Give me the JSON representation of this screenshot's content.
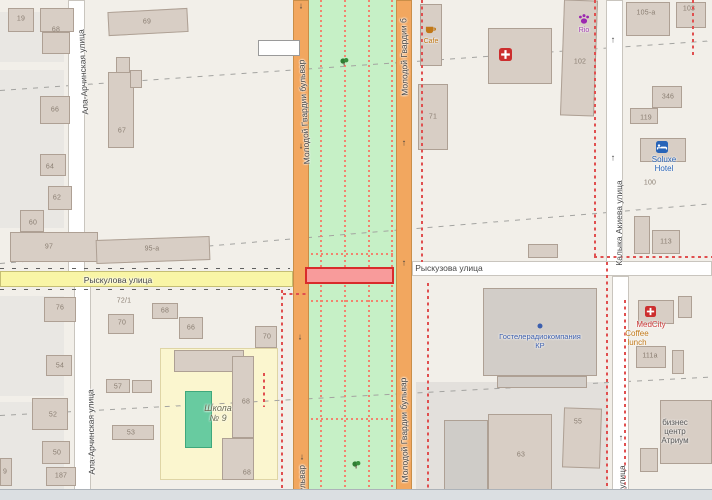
{
  "map": {
    "canvas": {
      "width": 712,
      "height": 500,
      "land_color": "#F2EFE9"
    },
    "landuse": [
      {
        "name": "landuse-residential",
        "x": 0,
        "y": 12,
        "w": 64,
        "h": 50,
        "color": "#E9E7E3"
      },
      {
        "name": "landuse-residential",
        "x": 0,
        "y": 70,
        "w": 64,
        "h": 158,
        "color": "#E9E7E3"
      },
      {
        "name": "landuse-residential",
        "x": 0,
        "y": 296,
        "w": 64,
        "h": 100,
        "color": "#E9E7E3"
      },
      {
        "name": "landuse-residential",
        "x": 0,
        "y": 402,
        "w": 64,
        "h": 98,
        "color": "#E9E7E3"
      },
      {
        "name": "landuse-grass-median",
        "x": 309,
        "y": 0,
        "w": 87,
        "h": 500,
        "color": "#C6F0C6"
      },
      {
        "name": "landuse-school",
        "x": 160,
        "y": 348,
        "w": 118,
        "h": 132,
        "color": "#FBF6CF",
        "border": "#DFD5A5"
      },
      {
        "name": "landuse-retail-gray",
        "x": 416,
        "y": 382,
        "w": 192,
        "h": 118,
        "color": "#E3E0DC"
      }
    ],
    "roads": [
      {
        "name": "road-ala-archinskaya-north",
        "x": 68,
        "y": 0,
        "w": 17,
        "h": 272,
        "fill": "#FFFFFF",
        "casing": "#C9C5BE"
      },
      {
        "name": "road-ala-archinskaya-south",
        "x": 74,
        "y": 286,
        "w": 17,
        "h": 214,
        "fill": "#FFFFFF",
        "casing": "#C9C5BE"
      },
      {
        "name": "road-kalyka-akieva-north",
        "x": 606,
        "y": 0,
        "w": 17,
        "h": 262,
        "fill": "#FFFFFF",
        "casing": "#C9C5BE"
      },
      {
        "name": "road-kalyka-akieva-south",
        "x": 612,
        "y": 276,
        "w": 17,
        "h": 224,
        "fill": "#FFFFFF",
        "casing": "#C9C5BE"
      },
      {
        "name": "road-ryskulova-west",
        "x": 0,
        "y": 271,
        "w": 293,
        "h": 16,
        "fill": "#F9F5A6",
        "casing": "#C5BE74"
      },
      {
        "name": "road-ryskulova-east",
        "x": 412,
        "y": 261,
        "w": 300,
        "h": 15,
        "fill": "#FFFFFF",
        "casing": "#C9C5BE"
      },
      {
        "name": "road-blvd-west-carriageway",
        "x": 293,
        "y": 0,
        "w": 16,
        "h": 500,
        "fill": "#F2A75F",
        "casing": "#C98E48"
      },
      {
        "name": "road-blvd-east-carriageway",
        "x": 396,
        "y": 0,
        "w": 16,
        "h": 500,
        "fill": "#F2A75F",
        "casing": "#C98E48"
      }
    ],
    "road_ticks": [
      {
        "x": 0,
        "y": 267.5,
        "w": 290
      },
      {
        "x": 0,
        "y": 288.5,
        "w": 290
      }
    ],
    "boundaries_gray": [
      {
        "x": 0,
        "y": 90,
        "len": 716,
        "angle": -4.0
      },
      {
        "x": 0,
        "y": 263,
        "len": 716,
        "angle": -4.8
      },
      {
        "x": 0,
        "y": 415,
        "len": 716,
        "angle": -3.1
      }
    ],
    "boundaries_red": [
      {
        "orient": "v",
        "x": 421,
        "y": 0,
        "len": 262
      },
      {
        "orient": "v",
        "x": 427,
        "y": 283,
        "len": 217
      },
      {
        "orient": "v",
        "x": 281,
        "y": 290,
        "len": 210
      },
      {
        "orient": "v",
        "x": 263,
        "y": 373,
        "len": 34
      },
      {
        "orient": "h",
        "x": 283,
        "y": 293,
        "len": 26
      },
      {
        "orient": "v",
        "x": 594,
        "y": 0,
        "len": 256
      },
      {
        "orient": "h",
        "x": 594,
        "y": 256,
        "len": 118
      },
      {
        "orient": "v",
        "x": 606,
        "y": 262,
        "len": 238
      },
      {
        "orient": "v",
        "x": 624,
        "y": 300,
        "len": 200
      },
      {
        "orient": "v",
        "x": 692,
        "y": 0,
        "len": 55
      }
    ],
    "footpaths_dotted": [
      {
        "orient": "v",
        "x": 320,
        "y": 0,
        "len": 500
      },
      {
        "orient": "v",
        "x": 344,
        "y": 0,
        "len": 500
      },
      {
        "orient": "v",
        "x": 368,
        "y": 0,
        "len": 500
      },
      {
        "orient": "v",
        "x": 391,
        "y": 0,
        "len": 500
      },
      {
        "orient": "h",
        "x": 311,
        "y": 253,
        "len": 85
      },
      {
        "orient": "h",
        "x": 311,
        "y": 300,
        "len": 85
      },
      {
        "orient": "h",
        "x": 311,
        "y": 418,
        "len": 85
      }
    ],
    "highlight": {
      "name": "selection-highlight",
      "x": 305,
      "y": 267,
      "w": 89,
      "h": 17,
      "fill": "#F89B9B",
      "border": "#D92B2B"
    },
    "buildings": [
      {
        "x": 8,
        "y": 8,
        "w": 26,
        "h": 24
      },
      {
        "x": 40,
        "y": 8,
        "w": 34,
        "h": 24
      },
      {
        "x": 42,
        "y": 32,
        "w": 28,
        "h": 22
      },
      {
        "x": 108,
        "y": 10,
        "w": 80,
        "h": 24,
        "rot": -3
      },
      {
        "x": 116,
        "y": 57,
        "w": 14,
        "h": 30
      },
      {
        "x": 40,
        "y": 96,
        "w": 30,
        "h": 28
      },
      {
        "x": 108,
        "y": 72,
        "w": 26,
        "h": 76
      },
      {
        "x": 130,
        "y": 70,
        "w": 12,
        "h": 18
      },
      {
        "x": 40,
        "y": 154,
        "w": 26,
        "h": 22
      },
      {
        "x": 48,
        "y": 186,
        "w": 24,
        "h": 24
      },
      {
        "x": 20,
        "y": 210,
        "w": 24,
        "h": 22
      },
      {
        "x": 10,
        "y": 232,
        "w": 88,
        "h": 30
      },
      {
        "x": 96,
        "y": 238,
        "w": 114,
        "h": 24,
        "rot": -2
      },
      {
        "x": 258,
        "y": 40,
        "w": 42,
        "h": 16,
        "fill": "#FFFFFF",
        "border": "#9A9A9A"
      },
      {
        "x": 420,
        "y": 4,
        "w": 22,
        "h": 62
      },
      {
        "x": 488,
        "y": 28,
        "w": 64,
        "h": 56
      },
      {
        "x": 418,
        "y": 84,
        "w": 30,
        "h": 66
      },
      {
        "x": 562,
        "y": 0,
        "w": 34,
        "h": 116,
        "rot": 2
      },
      {
        "x": 626,
        "y": 2,
        "w": 44,
        "h": 34
      },
      {
        "x": 676,
        "y": 2,
        "w": 30,
        "h": 26
      },
      {
        "x": 652,
        "y": 86,
        "w": 30,
        "h": 22
      },
      {
        "x": 630,
        "y": 108,
        "w": 28,
        "h": 16
      },
      {
        "x": 640,
        "y": 138,
        "w": 46,
        "h": 24
      },
      {
        "x": 634,
        "y": 216,
        "w": 16,
        "h": 38
      },
      {
        "x": 652,
        "y": 230,
        "w": 28,
        "h": 24
      },
      {
        "x": 528,
        "y": 244,
        "w": 30,
        "h": 14
      },
      {
        "x": 483,
        "y": 288,
        "w": 114,
        "h": 88,
        "fill": "#D2CDC8"
      },
      {
        "x": 497,
        "y": 376,
        "w": 90,
        "h": 12,
        "fill": "#D2CDC8"
      },
      {
        "x": 638,
        "y": 300,
        "w": 36,
        "h": 24
      },
      {
        "x": 678,
        "y": 296,
        "w": 14,
        "h": 22
      },
      {
        "x": 636,
        "y": 346,
        "w": 30,
        "h": 22
      },
      {
        "x": 672,
        "y": 350,
        "w": 12,
        "h": 24
      },
      {
        "x": 660,
        "y": 400,
        "w": 52,
        "h": 64
      },
      {
        "x": 640,
        "y": 448,
        "w": 18,
        "h": 24
      },
      {
        "x": 563,
        "y": 408,
        "w": 38,
        "h": 60,
        "rot": 2
      },
      {
        "x": 488,
        "y": 414,
        "w": 64,
        "h": 84
      },
      {
        "x": 444,
        "y": 420,
        "w": 44,
        "h": 74,
        "fill": "#CFCCC8"
      },
      {
        "x": 174,
        "y": 350,
        "w": 70,
        "h": 22
      },
      {
        "x": 232,
        "y": 356,
        "w": 22,
        "h": 82
      },
      {
        "x": 222,
        "y": 438,
        "w": 32,
        "h": 42
      },
      {
        "x": 185,
        "y": 391,
        "w": 27,
        "h": 57,
        "fill": "#68CBA0",
        "border": "#3FA87C"
      },
      {
        "x": 108,
        "y": 314,
        "w": 26,
        "h": 20
      },
      {
        "x": 152,
        "y": 303,
        "w": 26,
        "h": 16
      },
      {
        "x": 179,
        "y": 317,
        "w": 24,
        "h": 22
      },
      {
        "x": 255,
        "y": 326,
        "w": 22,
        "h": 22
      },
      {
        "x": 106,
        "y": 379,
        "w": 24,
        "h": 14
      },
      {
        "x": 132,
        "y": 380,
        "w": 20,
        "h": 13
      },
      {
        "x": 112,
        "y": 425,
        "w": 42,
        "h": 15
      },
      {
        "x": 44,
        "y": 297,
        "w": 32,
        "h": 25
      },
      {
        "x": 46,
        "y": 355,
        "w": 26,
        "h": 21
      },
      {
        "x": 32,
        "y": 398,
        "w": 36,
        "h": 32
      },
      {
        "x": 42,
        "y": 441,
        "w": 28,
        "h": 23
      },
      {
        "x": 46,
        "y": 467,
        "w": 30,
        "h": 19
      },
      {
        "x": 0,
        "y": 458,
        "w": 12,
        "h": 28
      }
    ],
    "housenumbers": [
      {
        "text": "19",
        "x": 21,
        "y": 19
      },
      {
        "text": "68",
        "x": 56,
        "y": 30
      },
      {
        "text": "69",
        "x": 147,
        "y": 22
      },
      {
        "text": "66",
        "x": 55,
        "y": 110
      },
      {
        "text": "67",
        "x": 122,
        "y": 131
      },
      {
        "text": "64",
        "x": 50,
        "y": 167
      },
      {
        "text": "62",
        "x": 57,
        "y": 198
      },
      {
        "text": "60",
        "x": 33,
        "y": 223
      },
      {
        "text": "97",
        "x": 49,
        "y": 247
      },
      {
        "text": "95-а",
        "x": 152,
        "y": 249
      },
      {
        "text": "72/1",
        "x": 124,
        "y": 301
      },
      {
        "text": "76",
        "x": 60,
        "y": 308
      },
      {
        "text": "70",
        "x": 122,
        "y": 323
      },
      {
        "text": "68",
        "x": 165,
        "y": 311
      },
      {
        "text": "66",
        "x": 191,
        "y": 328
      },
      {
        "text": "70",
        "x": 267,
        "y": 337
      },
      {
        "text": "57",
        "x": 118,
        "y": 387
      },
      {
        "text": "53",
        "x": 131,
        "y": 433
      },
      {
        "text": "54",
        "x": 60,
        "y": 366
      },
      {
        "text": "52",
        "x": 53,
        "y": 415
      },
      {
        "text": "50",
        "x": 57,
        "y": 453
      },
      {
        "text": "187",
        "x": 61,
        "y": 476
      },
      {
        "text": "9",
        "x": 5,
        "y": 472
      },
      {
        "text": "68",
        "x": 246,
        "y": 402
      },
      {
        "text": "68",
        "x": 247,
        "y": 473
      },
      {
        "text": "71",
        "x": 433,
        "y": 117
      },
      {
        "text": "102",
        "x": 580,
        "y": 62
      },
      {
        "text": "105-а",
        "x": 646,
        "y": 13
      },
      {
        "text": "103",
        "x": 689,
        "y": 9
      },
      {
        "text": "346",
        "x": 668,
        "y": 97
      },
      {
        "text": "119",
        "x": 646,
        "y": 118
      },
      {
        "text": "100",
        "x": 650,
        "y": 183
      },
      {
        "text": "113",
        "x": 666,
        "y": 242
      },
      {
        "text": "111а",
        "x": 650,
        "y": 356
      },
      {
        "text": "55",
        "x": 578,
        "y": 422
      },
      {
        "text": "63",
        "x": 521,
        "y": 455
      }
    ],
    "street_labels": [
      {
        "text": "Ала-Арчинская улица",
        "x": 83,
        "y": 72,
        "rot": -93
      },
      {
        "text": "Ала-Арчинская улица",
        "x": 91,
        "y": 432,
        "rot": -91
      },
      {
        "text": "Молодой Гвардии бульвар",
        "x": 304,
        "y": 112,
        "rot": -93
      },
      {
        "text": "Молодой Гвардии б",
        "x": 404,
        "y": 57,
        "rot": -91
      },
      {
        "text": "Молодой Гвардии бульвар",
        "x": 404,
        "y": 430,
        "rot": -91
      },
      {
        "text": "бульвар",
        "x": 302,
        "y": 481,
        "rot": -92
      },
      {
        "text": "Рыскулова улица",
        "x": 118,
        "y": 280,
        "rot": 0
      },
      {
        "text": "Рыскузова улица",
        "x": 449,
        "y": 268,
        "rot": 0
      },
      {
        "text": "Калыка Акиева улица",
        "x": 619,
        "y": 223,
        "rot": -90
      },
      {
        "text": "улица",
        "x": 622,
        "y": 477,
        "rot": -90
      }
    ],
    "poi_labels": [
      {
        "name": "cafe-label",
        "lines": [
          "Cafe"
        ],
        "x": 431,
        "y": 38,
        "color": "#C17817",
        "size": 7
      },
      {
        "name": "petshop-rio-label",
        "lines": [
          "Rio"
        ],
        "x": 584,
        "y": 27,
        "color": "#A23BB3",
        "size": 7
      },
      {
        "name": "soluxe-hotel-label",
        "lines": [
          "Soluxe",
          "Hotel"
        ],
        "x": 664,
        "y": 155,
        "color": "#2864B8",
        "size": 8
      },
      {
        "name": "broadcaster-label",
        "lines": [
          "Гостелерадиокомпания",
          "КР"
        ],
        "x": 540,
        "y": 333,
        "color": "#3C5FAE",
        "size": 7.5
      },
      {
        "name": "medcity-label",
        "lines": [
          "MedCity"
        ],
        "x": 651,
        "y": 320,
        "color": "#CC3B3B",
        "size": 8
      },
      {
        "name": "coffee-lunch-label",
        "lines": [
          "Coffee",
          "lunch"
        ],
        "x": 637,
        "y": 329,
        "color": "#C17817",
        "size": 8
      },
      {
        "name": "atrium-label",
        "lines": [
          "бизнес",
          "центр",
          "Атриум"
        ],
        "x": 675,
        "y": 418,
        "color": "#555555",
        "size": 8
      },
      {
        "name": "school-label",
        "lines": [
          "Школа",
          "№ 9"
        ],
        "x": 218,
        "y": 403,
        "color": "#6B6B52",
        "size": 9,
        "italic": true
      }
    ],
    "icons": [
      {
        "name": "pharmacy-icon",
        "kind": "medical",
        "x": 505,
        "y": 54,
        "color": "#CC2E2E",
        "s": 13
      },
      {
        "name": "medcity-clinic-icon",
        "kind": "medical",
        "x": 650,
        "y": 311,
        "color": "#CC2E2E",
        "s": 11
      },
      {
        "name": "paw-icon",
        "kind": "paw",
        "x": 584,
        "y": 19,
        "color": "#9C27B0",
        "s": 12
      },
      {
        "name": "cafe-icon",
        "kind": "cup",
        "x": 430,
        "y": 29,
        "color": "#C17817",
        "s": 11
      },
      {
        "name": "hotel-bed-icon",
        "kind": "bed",
        "x": 662,
        "y": 147,
        "color": "#2864B8",
        "s": 12
      },
      {
        "name": "poi-dot-icon",
        "kind": "dot",
        "x": 540,
        "y": 326,
        "color": "#3C5FAE",
        "s": 6
      }
    ],
    "oneway_arrows": [
      {
        "x": 301,
        "y": 6,
        "dir": "↓"
      },
      {
        "x": 301,
        "y": 146,
        "dir": "↓"
      },
      {
        "x": 300,
        "y": 337,
        "dir": "↓"
      },
      {
        "x": 302,
        "y": 457,
        "dir": "↓"
      },
      {
        "x": 404,
        "y": 143,
        "dir": "↑"
      },
      {
        "x": 404,
        "y": 263,
        "dir": "↑"
      },
      {
        "x": 613,
        "y": 40,
        "dir": "↑"
      },
      {
        "x": 613,
        "y": 158,
        "dir": "↑"
      },
      {
        "x": 621,
        "y": 438,
        "dir": "↑"
      }
    ],
    "trees": [
      {
        "x": 344,
        "y": 61
      },
      {
        "x": 356,
        "y": 464
      }
    ]
  },
  "statusbar": {
    "color": "#DBDFE2",
    "border": "#ADB3B9",
    "x": 0,
    "y": 489,
    "w": 712,
    "h": 11
  }
}
